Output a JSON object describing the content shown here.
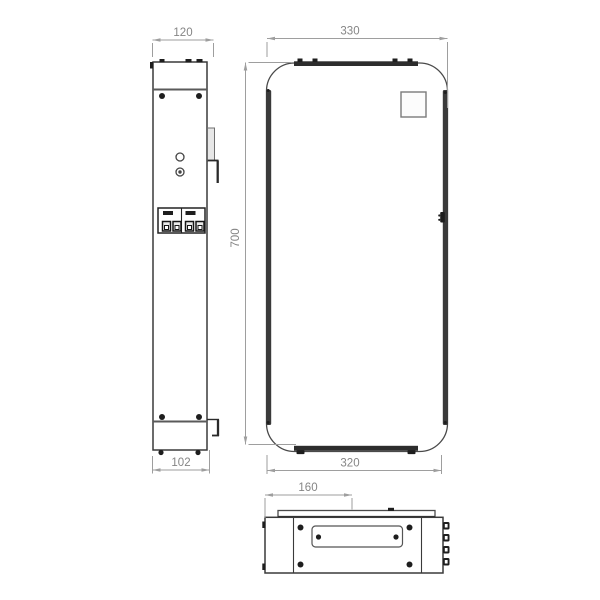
{
  "drawing": {
    "kind": "technical-dimension-drawing",
    "views": [
      "side-view",
      "front-view",
      "bottom-view"
    ]
  },
  "dimensions": {
    "side_width": "120",
    "front_width": "330",
    "front_height": "700",
    "side_base_depth": "102",
    "front_base_width": "320",
    "top_plate_offset": "160"
  },
  "colors": {
    "background": "#ffffff",
    "object_line": "#4a4a4a",
    "object_fill_dark": "#1e1e1e",
    "dimension_line": "#9e9e9e",
    "dimension_text": "#858585"
  }
}
